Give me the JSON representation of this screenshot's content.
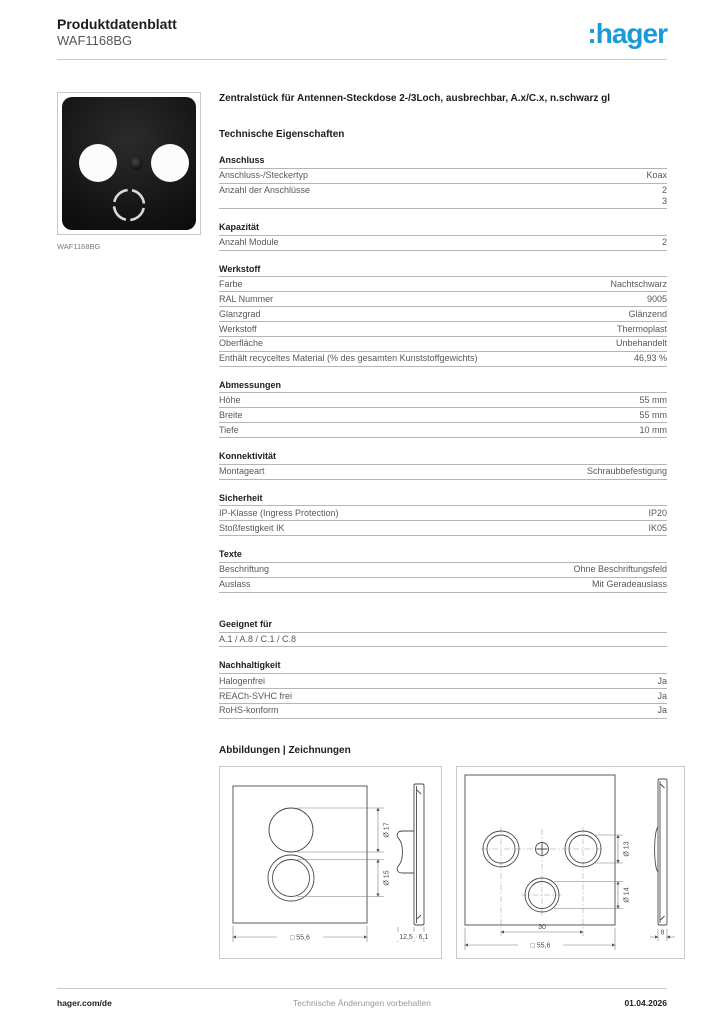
{
  "header": {
    "doc_title": "Produktdatenblatt",
    "product_ref": "WAF1168BG",
    "logo_text": ":hager"
  },
  "product": {
    "image_caption": "WAF1168BG",
    "description": "Zentralstück für Antennen-Steckdose 2-/3Loch, ausbrechbar, A.x/C.x, n.schwarz gl"
  },
  "tech_heading": "Technische Eigenschaften",
  "sections": [
    {
      "title": "Anschluss",
      "rows": [
        {
          "label": "Anschluss-/Steckertyp",
          "values": [
            "Koax"
          ]
        },
        {
          "label": "Anzahl der Anschlüsse",
          "values": [
            "2",
            "3"
          ]
        }
      ]
    },
    {
      "title": "Kapazität",
      "rows": [
        {
          "label": "Anzahl Module",
          "values": [
            "2"
          ]
        }
      ]
    },
    {
      "title": "Werkstoff",
      "rows": [
        {
          "label": "Farbe",
          "values": [
            "Nachtschwarz"
          ]
        },
        {
          "label": "RAL Nummer",
          "values": [
            "9005"
          ]
        },
        {
          "label": "Glanzgrad",
          "values": [
            "Glänzend"
          ]
        },
        {
          "label": "Werkstoff",
          "values": [
            "Thermoplast"
          ]
        },
        {
          "label": "Oberfläche",
          "values": [
            "Unbehandelt"
          ]
        },
        {
          "label": "Enthält recyceltes Material (% des gesamten Kunststoffgewichts)",
          "values": [
            "46,93 %"
          ]
        }
      ]
    },
    {
      "title": "Abmessungen",
      "rows": [
        {
          "label": "Höhe",
          "values": [
            "55 mm"
          ]
        },
        {
          "label": "Breite",
          "values": [
            "55 mm"
          ]
        },
        {
          "label": "Tiefe",
          "values": [
            "10 mm"
          ]
        }
      ]
    },
    {
      "title": "Konnektivität",
      "rows": [
        {
          "label": "Montageart",
          "values": [
            "Schraubbefestigung"
          ]
        }
      ]
    },
    {
      "title": "Sicherheit",
      "rows": [
        {
          "label": "IP-Klasse (Ingress Protection)",
          "values": [
            "IP20"
          ]
        },
        {
          "label": "Stoßfestigkeit IK",
          "values": [
            "IK05"
          ]
        }
      ]
    },
    {
      "title": "Texte",
      "rows": [
        {
          "label": "Beschriftung",
          "values": [
            "Ohne Beschriftungsfeld"
          ]
        },
        {
          "label": "Auslass",
          "values": [
            "Mit Geradeauslass"
          ]
        }
      ]
    },
    {
      "title": "Geeignet für",
      "rows": [
        {
          "label": "A.1 / A.8 / C.1 / C.8",
          "values": []
        }
      ]
    },
    {
      "title": "Nachhaltigkeit",
      "rows": [
        {
          "label": "Halogenfrei",
          "values": [
            "Ja"
          ]
        },
        {
          "label": "REACh-SVHC frei",
          "values": [
            "Ja"
          ]
        },
        {
          "label": "RoHS-konform",
          "values": [
            "Ja"
          ]
        }
      ]
    }
  ],
  "drawings": {
    "heading": "Abbildungen | Zeichnungen",
    "fig1": {
      "dia_top": "Ø 17",
      "dia_bottom": "Ø 15",
      "width": "□ 55,6",
      "depth_clip": "12,5",
      "depth_plate": "6,1"
    },
    "fig2": {
      "dia_right": "Ø 13",
      "dia_bottom": "Ø 14",
      "spacing": "30",
      "width": "□ 55,6",
      "depth_plate": "8"
    }
  },
  "footer": {
    "website": "hager.com/de",
    "notice": "Technische Änderungen vorbehalten",
    "date": "01.04.2026"
  },
  "colors": {
    "brand_blue": "#199BD7",
    "plate_black": "#0c0c0c",
    "rule_gray": "#b5b5b5"
  }
}
